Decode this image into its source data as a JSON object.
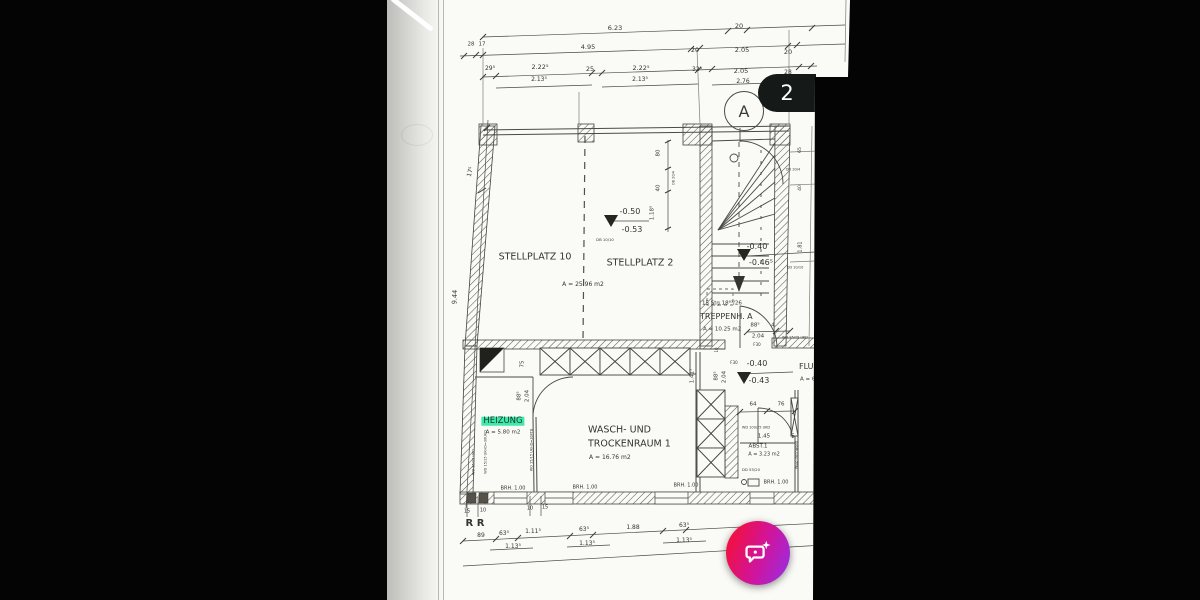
{
  "colors": {
    "paper": "#fafaf7",
    "ink": "#35352f",
    "highlight": "#3fe9ac",
    "badge_bg": "#151a19",
    "fab_from": "#ef1048",
    "fab_to": "#9a2ce0"
  },
  "overlay": {
    "page_badge": "2"
  },
  "fab": {
    "icon": "chat-bubble-sparkle"
  },
  "plan": {
    "section_marker": "A",
    "labels": [
      {
        "t": "6.23",
        "x": 228,
        "y": 28
      },
      {
        "t": "20",
        "x": 352,
        "y": 26
      },
      {
        "t": "28",
        "x": 84,
        "y": 45,
        "s": 5.5
      },
      {
        "t": "17",
        "x": 95,
        "y": 45,
        "s": 5.5
      },
      {
        "t": "4.95",
        "x": 201,
        "y": 47
      },
      {
        "t": "20",
        "x": 308,
        "y": 50
      },
      {
        "t": "2.05",
        "x": 355,
        "y": 50
      },
      {
        "t": "20",
        "x": 401,
        "y": 52
      },
      {
        "t": "29⁵",
        "x": 103,
        "y": 69,
        "s": 6
      },
      {
        "t": "2.22⁵",
        "x": 153,
        "y": 67
      },
      {
        "t": "25",
        "x": 203,
        "y": 69
      },
      {
        "t": "2.22⁵",
        "x": 254,
        "y": 68
      },
      {
        "t": "32⁵",
        "x": 310,
        "y": 70,
        "s": 6
      },
      {
        "t": "2.05",
        "x": 354,
        "y": 71
      },
      {
        "t": "28",
        "x": 401,
        "y": 73,
        "s": 6
      },
      {
        "t": "2.13⁵",
        "x": 152,
        "y": 80,
        "s": 6
      },
      {
        "t": "2.13⁵",
        "x": 253,
        "y": 80,
        "s": 6
      },
      {
        "t": "2.76",
        "x": 356,
        "y": 82,
        "s": 6
      },
      {
        "t": "17⁵",
        "x": 84,
        "y": 172,
        "s": 6,
        "r": -75
      },
      {
        "t": "9.44",
        "x": 68,
        "y": 297,
        "s": 6.5,
        "r": -87
      },
      {
        "t": "STELLPLATZ 10",
        "x": 148,
        "y": 257,
        "s": 9.5,
        "n": "room-label-stellplatz-10"
      },
      {
        "t": "STELLPLATZ 2",
        "x": 253,
        "y": 263,
        "s": 9.5,
        "n": "room-label-stellplatz-2"
      },
      {
        "t": "A = 25.96 m2",
        "x": 196,
        "y": 285,
        "s": 6
      },
      {
        "t": "-0.50",
        "x": 243,
        "y": 212,
        "s": 8,
        "n": "level-value"
      },
      {
        "t": "-0.53",
        "x": 245,
        "y": 230,
        "s": 8,
        "n": "level-value"
      },
      {
        "t": "-0.40",
        "x": 370,
        "y": 247,
        "s": 8,
        "n": "level-value"
      },
      {
        "t": "-0.46⁵",
        "x": 374,
        "y": 263,
        "s": 8,
        "n": "level-value"
      },
      {
        "t": "15 Stg 18⁸³/26",
        "x": 315,
        "y": 304,
        "s": 5.5,
        "a": "l",
        "n": "stair-count-note"
      },
      {
        "t": "TREPPENH. A",
        "x": 313,
        "y": 317,
        "s": 8,
        "a": "l",
        "n": "room-label-treppenhaus-a"
      },
      {
        "t": "A = 10.25 m2",
        "x": 316,
        "y": 330,
        "s": 5.5,
        "a": "l"
      },
      {
        "t": "88⁵",
        "x": 368,
        "y": 326,
        "s": 5.5
      },
      {
        "t": "4",
        "x": 386,
        "y": 326,
        "s": 5.5
      },
      {
        "t": "2.04",
        "x": 371,
        "y": 337,
        "s": 5.5
      },
      {
        "t": "F30",
        "x": 370,
        "y": 345,
        "s": 4
      },
      {
        "t": "DB 10/10",
        "x": 218,
        "y": 240,
        "s": 3.8
      },
      {
        "t": "80",
        "x": 272,
        "y": 153,
        "s": 5.5,
        "r": -90
      },
      {
        "t": "40",
        "x": 272,
        "y": 188,
        "s": 5.5,
        "r": -90
      },
      {
        "t": "1.18⁵",
        "x": 266,
        "y": 213,
        "s": 5.5,
        "r": -90
      },
      {
        "t": "DB 20/4",
        "x": 287,
        "y": 178,
        "s": 3.5,
        "r": -90
      },
      {
        "t": "65",
        "x": 414,
        "y": 150,
        "s": 4.5,
        "r": -90
      },
      {
        "t": "DD 20/4",
        "x": 406,
        "y": 170,
        "s": 3.5
      },
      {
        "t": "40",
        "x": 414,
        "y": 188,
        "s": 4.5,
        "r": -90
      },
      {
        "t": "1.81",
        "x": 414,
        "y": 247,
        "s": 5,
        "r": -90
      },
      {
        "t": "DD 10/10",
        "x": 408,
        "y": 268,
        "s": 3.5
      },
      {
        "t": "WD 25/25 UKD",
        "x": 408,
        "y": 338,
        "s": 3.5
      },
      {
        "t": "FLUR",
        "x": 412,
        "y": 367,
        "s": 8,
        "a": "l",
        "n": "room-label-flur"
      },
      {
        "t": "A = 6",
        "x": 413,
        "y": 380,
        "s": 5.5,
        "a": "l"
      },
      {
        "t": "F30",
        "x": 347,
        "y": 363,
        "s": 4
      },
      {
        "t": "-0.40",
        "x": 370,
        "y": 364,
        "s": 8,
        "n": "level-value"
      },
      {
        "t": "-0.43",
        "x": 372,
        "y": 381,
        "s": 8,
        "n": "level-value"
      },
      {
        "t": "88⁵",
        "x": 330,
        "y": 376,
        "s": 5.5,
        "r": -90
      },
      {
        "t": "2.04",
        "x": 338,
        "y": 377,
        "s": 5.5,
        "r": -90
      },
      {
        "t": "10",
        "x": 330,
        "y": 350,
        "s": 4,
        "r": -90
      },
      {
        "t": "1.41⁵",
        "x": 306,
        "y": 376,
        "s": 5.5,
        "r": -90
      },
      {
        "t": "64",
        "x": 366,
        "y": 405,
        "s": 5.5
      },
      {
        "t": "76",
        "x": 394,
        "y": 405,
        "s": 5.5
      },
      {
        "t": "WD 100/25 UKD",
        "x": 369,
        "y": 428,
        "s": 3.5
      },
      {
        "t": "1.45",
        "x": 377,
        "y": 437,
        "s": 5.5
      },
      {
        "t": "5",
        "x": 406,
        "y": 437,
        "s": 5.5
      },
      {
        "t": "ABST.1",
        "x": 371,
        "y": 447,
        "s": 5.5,
        "n": "room-label-abst-1"
      },
      {
        "t": "A = 3.23 m2",
        "x": 377,
        "y": 455,
        "s": 5
      },
      {
        "t": "DD 55/20",
        "x": 364,
        "y": 470,
        "s": 3.8
      },
      {
        "t": "BRH. 1.00",
        "x": 389,
        "y": 483,
        "s": 5
      },
      {
        "t": "WBZ-Trennwand",
        "x": 410,
        "y": 455,
        "s": 3.5,
        "r": -90
      },
      {
        "t": "HEIZUNG",
        "x": 116,
        "y": 421,
        "s": 8.5,
        "hl": true,
        "n": "room-label-heizung"
      },
      {
        "t": "A = 5.80 m2",
        "x": 116,
        "y": 433,
        "s": 5.5
      },
      {
        "t": "WASCH- UND",
        "x": 201,
        "y": 430,
        "s": 9.5,
        "a": "l",
        "n": "room-label-wasch-und-trockenraum"
      },
      {
        "t": "TROCKENRAUM 1",
        "x": 201,
        "y": 444,
        "s": 9.5,
        "a": "l",
        "n": "room-label-wasch-und-trockenraum"
      },
      {
        "t": "A = 16.76 m2",
        "x": 202,
        "y": 458,
        "s": 6,
        "a": "l"
      },
      {
        "t": "75",
        "x": 136,
        "y": 364,
        "s": 5.5,
        "r": -90
      },
      {
        "t": "88⁵",
        "x": 133,
        "y": 396,
        "s": 5.5,
        "r": -90
      },
      {
        "t": "2.04",
        "x": 141,
        "y": 396,
        "s": 5.5,
        "r": -90
      },
      {
        "t": "WD 15/15 UKD",
        "x": 87,
        "y": 462,
        "s": 3.5,
        "r": -90
      },
      {
        "t": "WD 15/15 UKHD=30UKD",
        "x": 99,
        "y": 452,
        "s": 3.5,
        "r": -90
      },
      {
        "t": "WD 15/15 UKHD=30FTB",
        "x": 145,
        "y": 450,
        "s": 3.5,
        "r": -90
      },
      {
        "t": "BRH. 1.00",
        "x": 126,
        "y": 489,
        "s": 5
      },
      {
        "t": "BRH. 1.00",
        "x": 198,
        "y": 488,
        "s": 5
      },
      {
        "t": "BRH. 1.00",
        "x": 299,
        "y": 486,
        "s": 5
      },
      {
        "t": "15",
        "x": 80,
        "y": 512,
        "s": 5
      },
      {
        "t": "10",
        "x": 96,
        "y": 511,
        "s": 5
      },
      {
        "t": "10",
        "x": 143,
        "y": 509,
        "s": 5
      },
      {
        "t": "15",
        "x": 158,
        "y": 508,
        "s": 5
      },
      {
        "t": "R R",
        "x": 88,
        "y": 524,
        "s": 10,
        "b": true,
        "n": "handwritten-rr-mark"
      },
      {
        "t": "89",
        "x": 94,
        "y": 536,
        "s": 6
      },
      {
        "t": "63⁵",
        "x": 117,
        "y": 534,
        "s": 6
      },
      {
        "t": "1.11⁵",
        "x": 146,
        "y": 532,
        "s": 6
      },
      {
        "t": "63⁵",
        "x": 197,
        "y": 530,
        "s": 6
      },
      {
        "t": "1.88",
        "x": 246,
        "y": 528,
        "s": 6
      },
      {
        "t": "63⁵",
        "x": 297,
        "y": 526,
        "s": 6
      },
      {
        "t": "1.13⁵",
        "x": 126,
        "y": 547,
        "s": 6
      },
      {
        "t": "1.13⁵",
        "x": 200,
        "y": 544,
        "s": 6
      },
      {
        "t": "1.13⁵",
        "x": 297,
        "y": 541,
        "s": 6
      }
    ]
  }
}
